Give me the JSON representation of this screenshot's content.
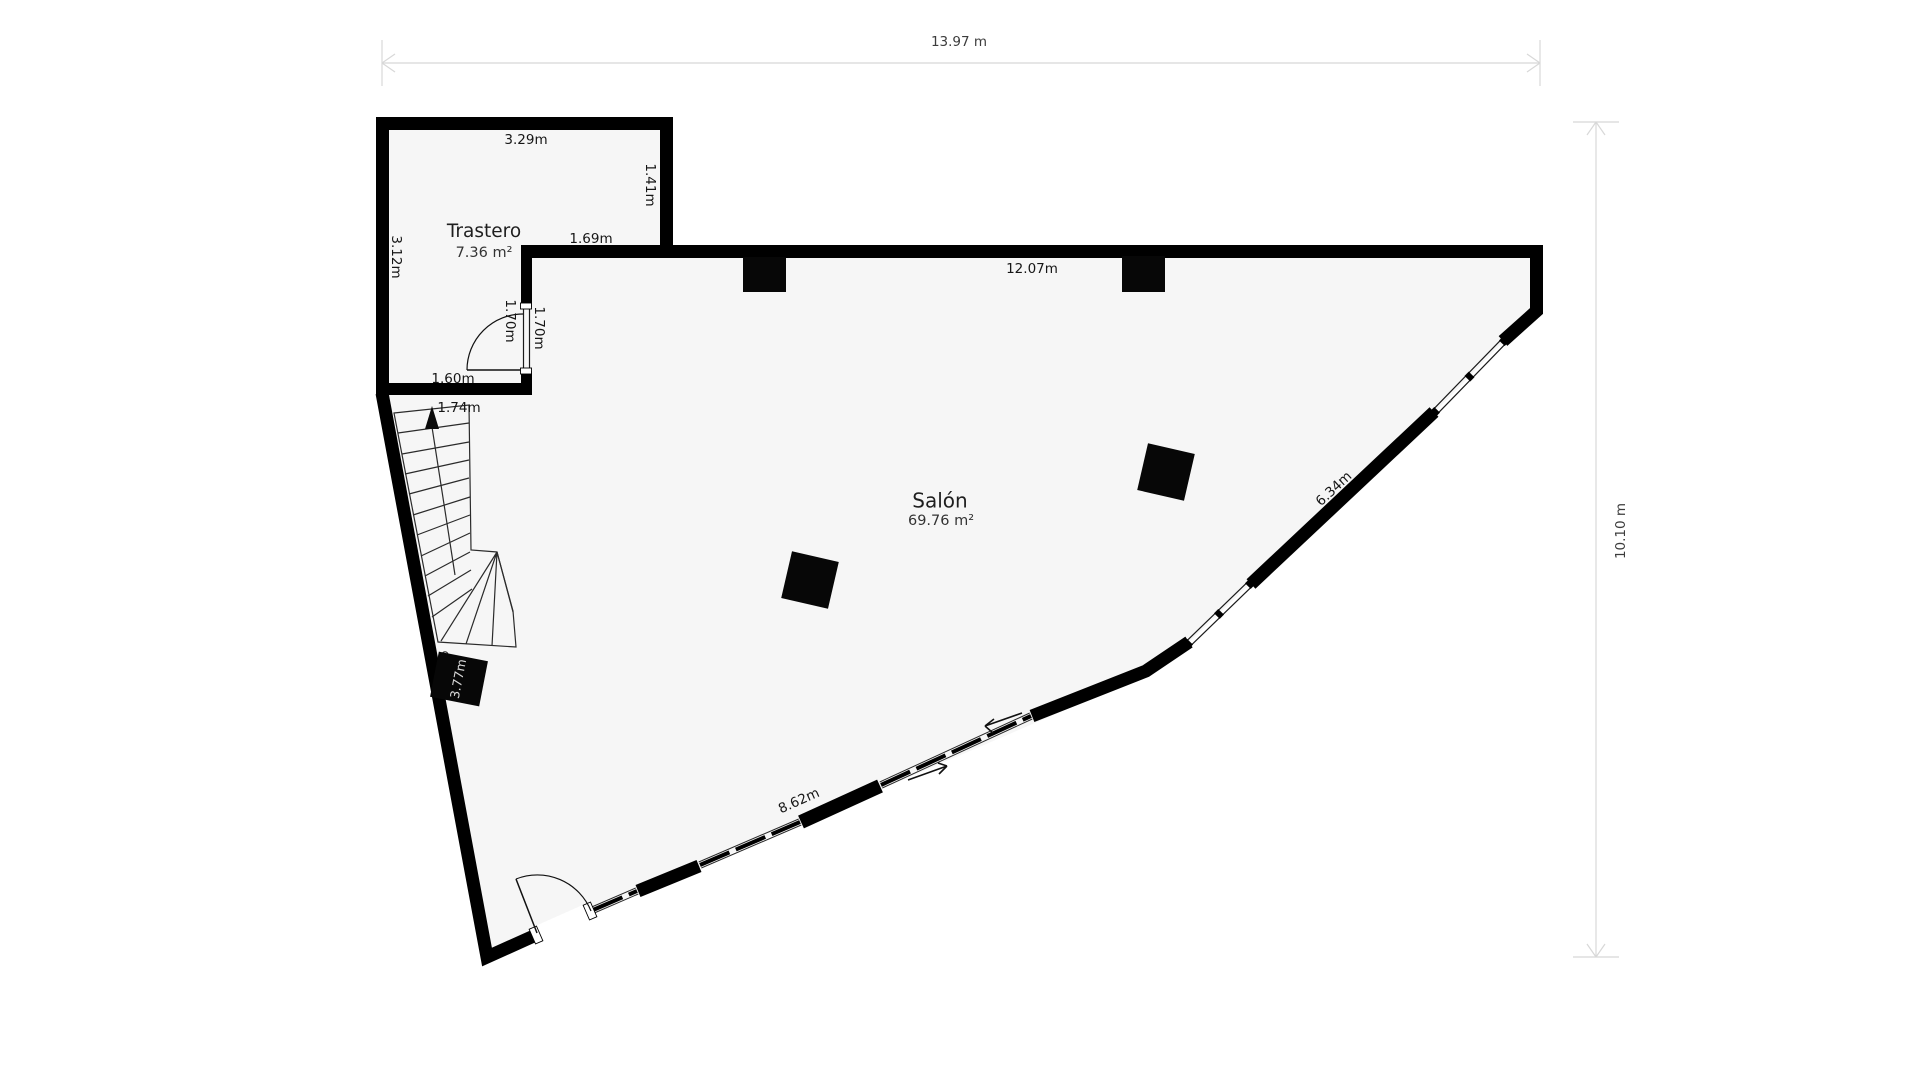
{
  "plan": {
    "type": "floor-plan",
    "rooms": {
      "trastero": {
        "name": "Trastero",
        "area": "7.36 m²"
      },
      "salon": {
        "name": "Salón",
        "area": "69.76 m²"
      }
    },
    "overall_dimensions": {
      "width": "13.97 m",
      "height": "10.10 m"
    },
    "measurements": {
      "trastero_top_width": "3.29m",
      "trastero_right_height": "1.41m",
      "trastero_left_height": "3.12m",
      "partition_top": "1.69m",
      "door_inner": "1.70m",
      "door_outer": "1.70m",
      "trastero_bottom_width": "1.60m",
      "stairs_width": "1.74m",
      "salon_top_width": "12.07m",
      "salon_diagonal": "6.34m",
      "salon_bottom": "8.62m",
      "left_wall_segment": "3.77m"
    },
    "colors": {
      "wall": "#000000",
      "floor": "#f6f6f6",
      "background": "#ffffff",
      "dimension_line": "#d8d8d8",
      "dimension_text": "#3c3c3c",
      "label_text": "#1f1f1f"
    }
  }
}
